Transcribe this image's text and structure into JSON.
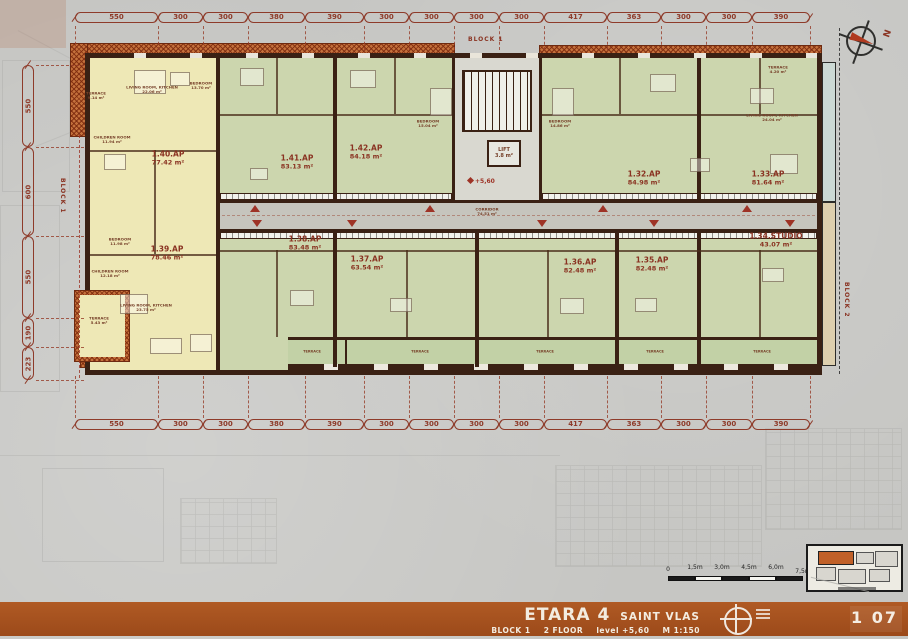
{
  "meta": {
    "north": "N"
  },
  "title_block": {
    "project": "ETARA 4",
    "location": "SAINT VLAS",
    "block": "BLOCK 1",
    "floor": "2 FLOOR",
    "level": "level +5,60",
    "scale": "M 1:150",
    "sheet": "1 07"
  },
  "labels": {
    "block_top": "BLOCK 1",
    "block_left": "BLOCK 1",
    "block_right": "BLOCK 2",
    "corridor_name": "CORRIDOR",
    "corridor_area": "74.51 m²",
    "lift_name": "LIFT",
    "lift_area": "3.8 m²",
    "level_mark": "+5,60",
    "terrace": "TERRACE"
  },
  "dimensions": {
    "top": [
      "550",
      "300",
      "300",
      "380",
      "390",
      "300",
      "300",
      "300",
      "300",
      "417",
      "363",
      "300",
      "300",
      "390"
    ],
    "bottom": [
      "550",
      "300",
      "300",
      "380",
      "390",
      "300",
      "300",
      "300",
      "300",
      "417",
      "363",
      "300",
      "300",
      "390"
    ],
    "left": [
      "550",
      "600",
      "550",
      "190",
      "223"
    ]
  },
  "scale_bar": {
    "labels": [
      "0",
      "1,5m",
      "3,0m",
      "4,5m",
      "6,0m",
      "7,5m"
    ]
  },
  "apartments": [
    {
      "id": "1.40.AP",
      "area": "77.42 m²"
    },
    {
      "id": "1.41.AP",
      "area": "83.13 m²"
    },
    {
      "id": "1.42.AP",
      "area": "84.18 m²"
    },
    {
      "id": "1.32.AP",
      "area": "84.98 m²"
    },
    {
      "id": "1.33.AP",
      "area": "81.64 m²"
    },
    {
      "id": "1.39.AP",
      "area": "78.46 m²"
    },
    {
      "id": "1.38.AP",
      "area": "83.48 m²"
    },
    {
      "id": "1.37.AP",
      "area": "63.54 m²"
    },
    {
      "id": "1.36.AP",
      "area": "82.48 m²"
    },
    {
      "id": "1.35.AP",
      "area": "82.48 m²"
    },
    {
      "id": "1.34.STUDIO",
      "area": "43.07 m²"
    }
  ],
  "rooms": [
    {
      "label": "TERRACE",
      "area": "9.14 m²"
    },
    {
      "label": "LIVING ROOM, KITCHEN",
      "area": "22.06 m²"
    },
    {
      "label": "BEDROOM",
      "area": "13.70 m²"
    },
    {
      "label": "CHILDREN ROOM",
      "area": "11.94 m²"
    },
    {
      "label": "BEDROOM",
      "area": "11.98 m²"
    },
    {
      "label": "CHILDREN ROOM",
      "area": "12.18 m²"
    },
    {
      "label": "LIVING ROOM, KITCHEN",
      "area": "23.75 m²"
    },
    {
      "label": "TERRACE",
      "area": "5.43 m²"
    },
    {
      "label": "BEDROOM",
      "area": "15.04 m²"
    },
    {
      "label": "BEDROOM",
      "area": "14.86 m²"
    },
    {
      "label": "LIVING ROOM, KITCHEN",
      "area": "24.04 m²"
    },
    {
      "label": "TERRACE",
      "area": "4.20 m²"
    }
  ],
  "colors": {
    "wall": "#3a2114",
    "dim_red": "#8e3b2a",
    "entry_red": "#9e3326",
    "roof_orange": "#c4713c",
    "room_green": "#ccd6ae",
    "room_yellow": "#eee8b6",
    "corridor_gray": "#c6c5bd",
    "titlebar_orange": "#a4511f"
  }
}
